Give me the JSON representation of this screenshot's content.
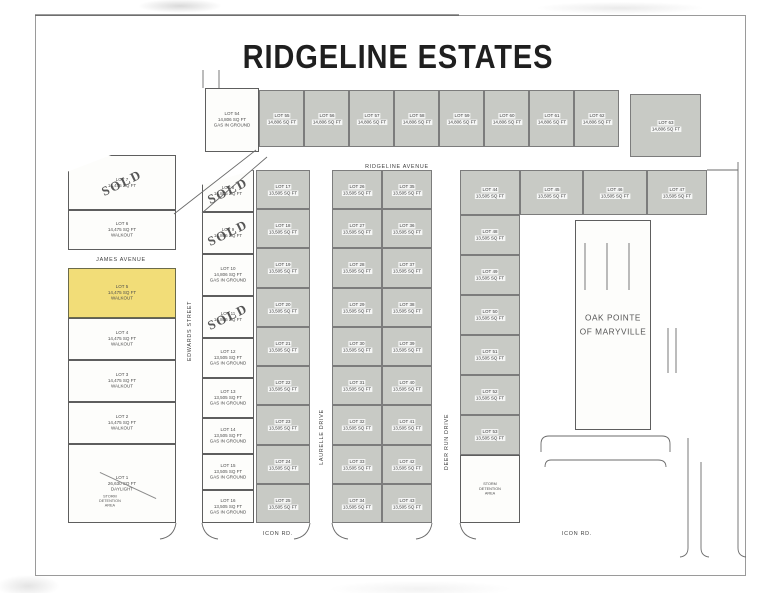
{
  "title": "RIDGELINE ESTATES",
  "sold_label": "SOLD",
  "streets": {
    "ridgeline_avenue": "RIDGELINE AVENUE",
    "james_avenue": "JAMES AVENUE",
    "edwards_street": "EDWARDS STREET",
    "laurelle_drive": "LAURELLE DRIVE",
    "deer_run_drive": "DEER RUN DRIVE",
    "icon_rd_left": "ICON RD.",
    "icon_rd_right": "ICON RD."
  },
  "colors": {
    "lot_gray": "#c8cac5",
    "lot_yellow": "#f2dd78",
    "line": "#6b6b6b",
    "sold_ink": "#404040"
  },
  "lots": [
    {
      "id": "54",
      "x": 205,
      "y": 88,
      "w": 54,
      "h": 64,
      "fill": "white",
      "lines": [
        "LOT 54",
        "14,806 SQ FT",
        "GAS IN GROUND"
      ]
    },
    {
      "id": "55",
      "x": 259,
      "y": 90,
      "w": 45,
      "h": 57,
      "fill": "gray",
      "lines": [
        "LOT 55",
        "14,806 SQ FT"
      ]
    },
    {
      "id": "56",
      "x": 304,
      "y": 90,
      "w": 45,
      "h": 57,
      "fill": "gray",
      "lines": [
        "LOT 56",
        "14,806 SQ FT"
      ]
    },
    {
      "id": "57",
      "x": 349,
      "y": 90,
      "w": 45,
      "h": 57,
      "fill": "gray",
      "lines": [
        "LOT 57",
        "14,806 SQ FT"
      ]
    },
    {
      "id": "58",
      "x": 394,
      "y": 90,
      "w": 45,
      "h": 57,
      "fill": "gray",
      "lines": [
        "LOT 58",
        "14,806 SQ FT"
      ]
    },
    {
      "id": "59",
      "x": 439,
      "y": 90,
      "w": 45,
      "h": 57,
      "fill": "gray",
      "lines": [
        "LOT 59",
        "14,806 SQ FT"
      ]
    },
    {
      "id": "60",
      "x": 484,
      "y": 90,
      "w": 45,
      "h": 57,
      "fill": "gray",
      "lines": [
        "LOT 60",
        "14,806 SQ FT"
      ]
    },
    {
      "id": "61",
      "x": 529,
      "y": 90,
      "w": 45,
      "h": 57,
      "fill": "gray",
      "lines": [
        "LOT 61",
        "14,806 SQ FT"
      ]
    },
    {
      "id": "62",
      "x": 574,
      "y": 90,
      "w": 45,
      "h": 57,
      "fill": "gray",
      "lines": [
        "LOT 62",
        "14,806 SQ FT"
      ]
    },
    {
      "id": "63",
      "x": 630,
      "y": 94,
      "w": 71,
      "h": 63,
      "fill": "gray",
      "lines": [
        "LOT 63",
        "14,806 SQ FT"
      ]
    },
    {
      "id": "7",
      "x": 68,
      "y": 155,
      "w": 108,
      "h": 55,
      "fill": "white",
      "sold": true,
      "clip": "polygon(0 30%, 40% 0, 100% 0, 100% 100%, 0 100%)",
      "lines": [
        "LOT 7",
        "14,475 SQ FT"
      ]
    },
    {
      "id": "6",
      "x": 68,
      "y": 210,
      "w": 108,
      "h": 40,
      "fill": "white",
      "lines": [
        "LOT 6",
        "14,475 SQ FT",
        "WALKOUT"
      ]
    },
    {
      "id": "5",
      "x": 68,
      "y": 268,
      "w": 108,
      "h": 50,
      "fill": "yellow",
      "lines": [
        "LOT 5",
        "14,475 SQ FT",
        "WALKOUT"
      ]
    },
    {
      "id": "4",
      "x": 68,
      "y": 318,
      "w": 108,
      "h": 42,
      "fill": "white",
      "lines": [
        "LOT 4",
        "14,475 SQ FT",
        "WALKOUT"
      ]
    },
    {
      "id": "3",
      "x": 68,
      "y": 360,
      "w": 108,
      "h": 42,
      "fill": "white",
      "lines": [
        "LOT 3",
        "14,475 SQ FT",
        "WALKOUT"
      ]
    },
    {
      "id": "2",
      "x": 68,
      "y": 402,
      "w": 108,
      "h": 42,
      "fill": "white",
      "lines": [
        "LOT 2",
        "14,475 SQ FT",
        "WALKOUT"
      ]
    },
    {
      "id": "1",
      "x": 68,
      "y": 444,
      "w": 108,
      "h": 79,
      "fill": "white",
      "lines": [
        "LOT 1",
        "26,630 SQ FT",
        "DAYLIGHT"
      ],
      "note": [
        "STORM",
        "DETENTION",
        "AREA"
      ],
      "diag": true
    },
    {
      "id": "8",
      "x": 202,
      "y": 170,
      "w": 52,
      "h": 42,
      "fill": "white",
      "sold": true,
      "clip": "polygon(0 35%, 100% 0, 100% 100%, 0 100%)",
      "lines": [
        "LOT 8",
        "14,806 SQ FT"
      ]
    },
    {
      "id": "9",
      "x": 202,
      "y": 212,
      "w": 52,
      "h": 42,
      "fill": "white",
      "sold": true,
      "lines": [
        "LOT 9",
        "14,806 SQ FT"
      ]
    },
    {
      "id": "10",
      "x": 202,
      "y": 254,
      "w": 52,
      "h": 42,
      "fill": "white",
      "lines": [
        "LOT 10",
        "14,806 SQ FT",
        "GAS IN GROUND"
      ]
    },
    {
      "id": "11",
      "x": 202,
      "y": 296,
      "w": 52,
      "h": 42,
      "fill": "white",
      "sold": true,
      "lines": [
        "LOT 11",
        "14,806 SQ FT"
      ]
    },
    {
      "id": "12",
      "x": 202,
      "y": 338,
      "w": 52,
      "h": 40,
      "fill": "white",
      "lines": [
        "LOT 12",
        "13,505 SQ FT",
        "GAS IN GROUND"
      ]
    },
    {
      "id": "13",
      "x": 202,
      "y": 378,
      "w": 52,
      "h": 40,
      "fill": "white",
      "lines": [
        "LOT 13",
        "13,505 SQ FT",
        "GAS IN GROUND"
      ]
    },
    {
      "id": "14",
      "x": 202,
      "y": 418,
      "w": 52,
      "h": 36,
      "fill": "white",
      "lines": [
        "LOT 14",
        "13,505 SQ FT",
        "GAS IN GROUND"
      ]
    },
    {
      "id": "15",
      "x": 202,
      "y": 454,
      "w": 52,
      "h": 36,
      "fill": "white",
      "lines": [
        "LOT 15",
        "13,505 SQ FT",
        "GAS IN GROUND"
      ]
    },
    {
      "id": "16",
      "x": 202,
      "y": 490,
      "w": 52,
      "h": 33,
      "fill": "white",
      "lines": [
        "LOT 16",
        "13,505 SQ FT",
        "GAS IN GROUND"
      ]
    },
    {
      "id": "17",
      "x": 256,
      "y": 170,
      "w": 54,
      "h": 39,
      "fill": "gray",
      "lines": [
        "LOT 17",
        "13,505 SQ FT"
      ]
    },
    {
      "id": "18",
      "x": 256,
      "y": 209,
      "w": 54,
      "h": 39,
      "fill": "gray",
      "lines": [
        "LOT 18",
        "13,505 SQ FT"
      ]
    },
    {
      "id": "19",
      "x": 256,
      "y": 248,
      "w": 54,
      "h": 40,
      "fill": "gray",
      "lines": [
        "LOT 19",
        "13,505 SQ FT"
      ]
    },
    {
      "id": "20",
      "x": 256,
      "y": 288,
      "w": 54,
      "h": 39,
      "fill": "gray",
      "lines": [
        "LOT 20",
        "13,505 SQ FT"
      ]
    },
    {
      "id": "21",
      "x": 256,
      "y": 327,
      "w": 54,
      "h": 39,
      "fill": "gray",
      "lines": [
        "LOT 21",
        "13,505 SQ FT"
      ]
    },
    {
      "id": "22",
      "x": 256,
      "y": 366,
      "w": 54,
      "h": 39,
      "fill": "gray",
      "lines": [
        "LOT 22",
        "13,505 SQ FT"
      ]
    },
    {
      "id": "23",
      "x": 256,
      "y": 405,
      "w": 54,
      "h": 40,
      "fill": "gray",
      "lines": [
        "LOT 23",
        "13,505 SQ FT"
      ]
    },
    {
      "id": "24",
      "x": 256,
      "y": 445,
      "w": 54,
      "h": 39,
      "fill": "gray",
      "lines": [
        "LOT 24",
        "13,505 SQ FT"
      ]
    },
    {
      "id": "25",
      "x": 256,
      "y": 484,
      "w": 54,
      "h": 39,
      "fill": "gray",
      "lines": [
        "LOT 25",
        "13,505 SQ FT"
      ]
    },
    {
      "id": "26",
      "x": 332,
      "y": 170,
      "w": 50,
      "h": 39,
      "fill": "gray",
      "lines": [
        "LOT 26",
        "13,505 SQ FT"
      ]
    },
    {
      "id": "27",
      "x": 332,
      "y": 209,
      "w": 50,
      "h": 39,
      "fill": "gray",
      "lines": [
        "LOT 27",
        "13,505 SQ FT"
      ]
    },
    {
      "id": "28",
      "x": 332,
      "y": 248,
      "w": 50,
      "h": 40,
      "fill": "gray",
      "lines": [
        "LOT 28",
        "13,505 SQ FT"
      ]
    },
    {
      "id": "29",
      "x": 332,
      "y": 288,
      "w": 50,
      "h": 39,
      "fill": "gray",
      "lines": [
        "LOT 29",
        "13,505 SQ FT"
      ]
    },
    {
      "id": "30",
      "x": 332,
      "y": 327,
      "w": 50,
      "h": 39,
      "fill": "gray",
      "lines": [
        "LOT 30",
        "13,505 SQ FT"
      ]
    },
    {
      "id": "31",
      "x": 332,
      "y": 366,
      "w": 50,
      "h": 39,
      "fill": "gray",
      "lines": [
        "LOT 31",
        "13,505 SQ FT"
      ]
    },
    {
      "id": "32",
      "x": 332,
      "y": 405,
      "w": 50,
      "h": 40,
      "fill": "gray",
      "lines": [
        "LOT 32",
        "13,505 SQ FT"
      ]
    },
    {
      "id": "33",
      "x": 332,
      "y": 445,
      "w": 50,
      "h": 39,
      "fill": "gray",
      "lines": [
        "LOT 33",
        "13,505 SQ FT"
      ]
    },
    {
      "id": "34",
      "x": 332,
      "y": 484,
      "w": 50,
      "h": 39,
      "fill": "gray",
      "lines": [
        "LOT 34",
        "13,505 SQ FT"
      ]
    },
    {
      "id": "35",
      "x": 382,
      "y": 170,
      "w": 50,
      "h": 39,
      "fill": "gray",
      "lines": [
        "LOT 35",
        "13,505 SQ FT"
      ]
    },
    {
      "id": "36",
      "x": 382,
      "y": 209,
      "w": 50,
      "h": 39,
      "fill": "gray",
      "lines": [
        "LOT 36",
        "13,505 SQ FT"
      ]
    },
    {
      "id": "37",
      "x": 382,
      "y": 248,
      "w": 50,
      "h": 40,
      "fill": "gray",
      "lines": [
        "LOT 37",
        "13,505 SQ FT"
      ]
    },
    {
      "id": "38",
      "x": 382,
      "y": 288,
      "w": 50,
      "h": 39,
      "fill": "gray",
      "lines": [
        "LOT 38",
        "13,505 SQ FT"
      ]
    },
    {
      "id": "39",
      "x": 382,
      "y": 327,
      "w": 50,
      "h": 39,
      "fill": "gray",
      "lines": [
        "LOT 39",
        "13,505 SQ FT"
      ]
    },
    {
      "id": "40",
      "x": 382,
      "y": 366,
      "w": 50,
      "h": 39,
      "fill": "gray",
      "lines": [
        "LOT 40",
        "13,505 SQ FT"
      ]
    },
    {
      "id": "41",
      "x": 382,
      "y": 405,
      "w": 50,
      "h": 40,
      "fill": "gray",
      "lines": [
        "LOT 41",
        "13,505 SQ FT"
      ]
    },
    {
      "id": "42",
      "x": 382,
      "y": 445,
      "w": 50,
      "h": 39,
      "fill": "gray",
      "lines": [
        "LOT 42",
        "13,505 SQ FT"
      ]
    },
    {
      "id": "43",
      "x": 382,
      "y": 484,
      "w": 50,
      "h": 39,
      "fill": "gray",
      "lines": [
        "LOT 43",
        "13,505 SQ FT"
      ]
    },
    {
      "id": "44",
      "x": 460,
      "y": 170,
      "w": 60,
      "h": 45,
      "fill": "gray",
      "lines": [
        "LOT 44",
        "13,505 SQ FT"
      ]
    },
    {
      "id": "45",
      "x": 520,
      "y": 170,
      "w": 63,
      "h": 45,
      "fill": "gray",
      "lines": [
        "LOT 45",
        "13,505 SQ FT"
      ]
    },
    {
      "id": "46",
      "x": 583,
      "y": 170,
      "w": 64,
      "h": 45,
      "fill": "gray",
      "lines": [
        "LOT 46",
        "13,505 SQ FT"
      ]
    },
    {
      "id": "47",
      "x": 647,
      "y": 170,
      "w": 60,
      "h": 45,
      "fill": "gray",
      "lines": [
        "LOT 47",
        "13,505 SQ FT"
      ]
    },
    {
      "id": "48",
      "x": 460,
      "y": 215,
      "w": 60,
      "h": 40,
      "fill": "gray",
      "lines": [
        "LOT 48",
        "13,505 SQ FT"
      ]
    },
    {
      "id": "49",
      "x": 460,
      "y": 255,
      "w": 60,
      "h": 40,
      "fill": "gray",
      "lines": [
        "LOT 49",
        "13,505 SQ FT"
      ]
    },
    {
      "id": "50",
      "x": 460,
      "y": 295,
      "w": 60,
      "h": 40,
      "fill": "gray",
      "lines": [
        "LOT 50",
        "13,505 SQ FT"
      ]
    },
    {
      "id": "51",
      "x": 460,
      "y": 335,
      "w": 60,
      "h": 40,
      "fill": "gray",
      "lines": [
        "LOT 51",
        "13,505 SQ FT"
      ]
    },
    {
      "id": "52",
      "x": 460,
      "y": 375,
      "w": 60,
      "h": 40,
      "fill": "gray",
      "lines": [
        "LOT 52",
        "13,505 SQ FT"
      ]
    },
    {
      "id": "53",
      "x": 460,
      "y": 415,
      "w": 60,
      "h": 40,
      "fill": "gray",
      "lines": [
        "LOT 53",
        "13,505 SQ FT"
      ]
    },
    {
      "id": "storm-right",
      "name": "storm-detention-area-right",
      "x": 460,
      "y": 455,
      "w": 60,
      "h": 68,
      "fill": "white",
      "labelSize": "sm",
      "lines": [
        "STORM",
        "DETENTION",
        "AREA"
      ]
    },
    {
      "id": "oak-pointe",
      "name": "oak-pointe-area",
      "x": 575,
      "y": 220,
      "w": 76,
      "h": 210,
      "fill": "white",
      "labelSize": "lg",
      "lines": [
        "OAK POINTE",
        "OF MARYVILLE"
      ]
    }
  ]
}
